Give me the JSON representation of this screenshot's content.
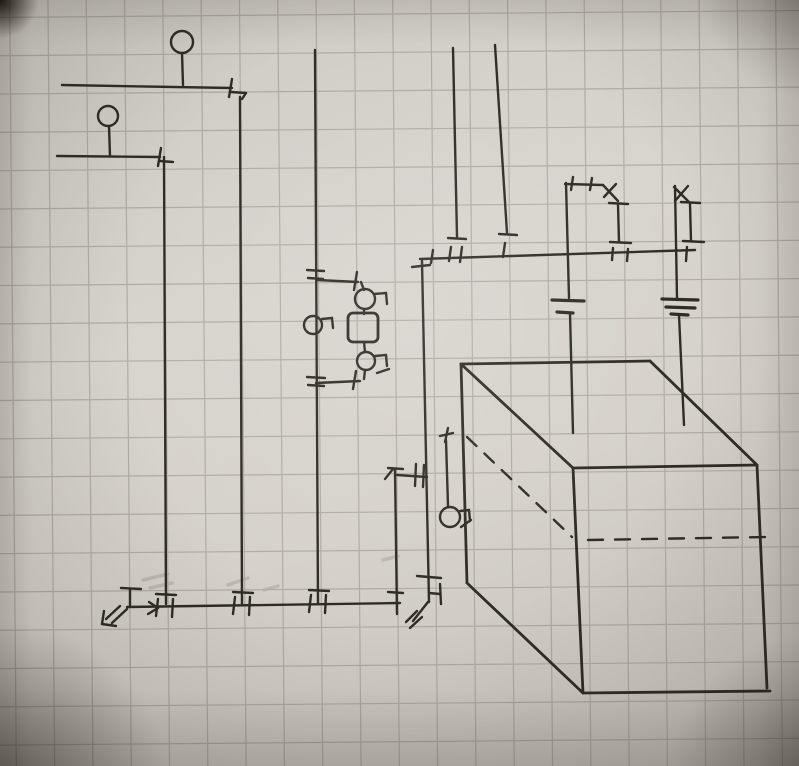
{
  "scene": {
    "description": "Photograph of a hand-drawn plumbing/heating schematic sketch in black ink on squared graph paper: pipe runs with valve ticks, two lollipop circles, a pump-bypass loop with a rounded square component, a top manifold bus with two battery-like symbols, a hanging circle sensor, a bottom manifold with arrow squiggles, and an oblique 3D box (tank) with dashed hidden lines.",
    "width": 799,
    "height": 766
  },
  "paper": {
    "color": "#d6d2cc"
  },
  "grid": {
    "spacing_x": 38.3,
    "spacing_y": 38.3,
    "offset_x": 13,
    "offset_y": 14,
    "color": "#8d887e",
    "opacity": 0.5,
    "width": 1.2,
    "rotation_deg": -0.5
  },
  "sketch": {
    "ink_color": "#2f2c27",
    "stroke_width": 2.4,
    "lines": [
      [
        182,
        53,
        183,
        85
      ],
      [
        62,
        85,
        232,
        88
      ],
      [
        232,
        79,
        229,
        97
      ],
      [
        231,
        92,
        246,
        93
      ],
      [
        246,
        93,
        242,
        99
      ],
      [
        240,
        97,
        242,
        604
      ],
      [
        109,
        126,
        110,
        156
      ],
      [
        57,
        156,
        160,
        157
      ],
      [
        161,
        148,
        158,
        166
      ],
      [
        160,
        161,
        173,
        162
      ],
      [
        164,
        157,
        166,
        604
      ],
      [
        315,
        50,
        318,
        604
      ],
      [
        307,
        270,
        324,
        271
      ],
      [
        308,
        278,
        323,
        279
      ],
      [
        317,
        280,
        358,
        282
      ],
      [
        357,
        272,
        354,
        290
      ],
      [
        361,
        282,
        364,
        290
      ],
      [
        374,
        294,
        386,
        293
      ],
      [
        386,
        293,
        387,
        304
      ],
      [
        364,
        309,
        364,
        314
      ],
      [
        364,
        342,
        365,
        352
      ],
      [
        375,
        356,
        386,
        355
      ],
      [
        386,
        355,
        387,
        366
      ],
      [
        377,
        373,
        389,
        369
      ],
      [
        365,
        370,
        364,
        379
      ],
      [
        356,
        371,
        353,
        389
      ],
      [
        316,
        383,
        360,
        381
      ],
      [
        307,
        377,
        325,
        378
      ],
      [
        308,
        385,
        324,
        386
      ],
      [
        322,
        319,
        332,
        318
      ],
      [
        332,
        318,
        333,
        328
      ],
      [
        127,
        607,
        400,
        603
      ],
      [
        130,
        589,
        130,
        607
      ],
      [
        121,
        588,
        141,
        589
      ],
      [
        127,
        609,
        112,
        623
      ],
      [
        120,
        606,
        106,
        619
      ],
      [
        104,
        611,
        102,
        624
      ],
      [
        102,
        624,
        116,
        626
      ],
      [
        149,
        602,
        158,
        608
      ],
      [
        158,
        608,
        148,
        614
      ],
      [
        156,
        594,
        176,
        595
      ],
      [
        158,
        599,
        156,
        616
      ],
      [
        173,
        599,
        172,
        617
      ],
      [
        233,
        592,
        253,
        593
      ],
      [
        235,
        597,
        233,
        614
      ],
      [
        250,
        597,
        249,
        615
      ],
      [
        309,
        590,
        329,
        591
      ],
      [
        311,
        595,
        309,
        612
      ],
      [
        326,
        595,
        325,
        613
      ],
      [
        395,
        470,
        397,
        614
      ],
      [
        388,
        468,
        403,
        469
      ],
      [
        385,
        479,
        393,
        469
      ],
      [
        388,
        592,
        403,
        593
      ],
      [
        397,
        475,
        427,
        477
      ],
      [
        416,
        464,
        415,
        486
      ],
      [
        424,
        465,
        423,
        487
      ],
      [
        422,
        261,
        429,
        602
      ],
      [
        412,
        267,
        430,
        265
      ],
      [
        417,
        576,
        441,
        578
      ],
      [
        440,
        584,
        441,
        604
      ],
      [
        429,
        593,
        440,
        594
      ],
      [
        428,
        602,
        413,
        621
      ],
      [
        417,
        611,
        406,
        622
      ],
      [
        422,
        617,
        410,
        628
      ],
      [
        446,
        440,
        448,
        506
      ],
      [
        440,
        436,
        453,
        433
      ],
      [
        448,
        428,
        445,
        442
      ],
      [
        460,
        511,
        469,
        510
      ],
      [
        469,
        510,
        470,
        521
      ],
      [
        461,
        527,
        471,
        520
      ],
      [
        420,
        259,
        695,
        250
      ],
      [
        431,
        263,
        433,
        250
      ],
      [
        453,
        48,
        457,
        237
      ],
      [
        448,
        238,
        466,
        239
      ],
      [
        451,
        247,
        449,
        261
      ],
      [
        462,
        247,
        460,
        262
      ],
      [
        495,
        45,
        507,
        233
      ],
      [
        499,
        234,
        517,
        235
      ],
      [
        505,
        243,
        503,
        257
      ],
      [
        618,
        205,
        619,
        242
      ],
      [
        609,
        203,
        628,
        204
      ],
      [
        610,
        242,
        631,
        243
      ],
      [
        613,
        248,
        612,
        260
      ],
      [
        628,
        249,
        627,
        261
      ],
      [
        690,
        204,
        691,
        241
      ],
      [
        681,
        202,
        700,
        203
      ],
      [
        683,
        241,
        704,
        242
      ],
      [
        687,
        247,
        686,
        261
      ],
      [
        566,
        183,
        569,
        298
      ],
      [
        565,
        184,
        603,
        185
      ],
      [
        573,
        177,
        571,
        190
      ],
      [
        592,
        178,
        590,
        190
      ],
      [
        603,
        185,
        618,
        201
      ],
      [
        604,
        197,
        616,
        184
      ],
      [
        552,
        300,
        584,
        301,
        3.2
      ],
      [
        557,
        312,
        573,
        313,
        3.2
      ],
      [
        570,
        313,
        573,
        433
      ],
      [
        674,
        187,
        689,
        202
      ],
      [
        675,
        201,
        688,
        186
      ],
      [
        675,
        186,
        677,
        298
      ],
      [
        662,
        299,
        698,
        300,
        3.2
      ],
      [
        666,
        307,
        695,
        308,
        3.2
      ],
      [
        671,
        314,
        688,
        315,
        3.2
      ],
      [
        679,
        315,
        684,
        425
      ],
      [
        461,
        364,
        650,
        361,
        2.8
      ],
      [
        461,
        364,
        467,
        583,
        2.8
      ],
      [
        461,
        364,
        573,
        468,
        2.8
      ],
      [
        650,
        361,
        757,
        465,
        2.8
      ],
      [
        573,
        468,
        757,
        465,
        2.8
      ],
      [
        573,
        468,
        583,
        693,
        2.8
      ],
      [
        757,
        465,
        767,
        688,
        2.8
      ],
      [
        583,
        693,
        770,
        691,
        2.8
      ],
      [
        467,
        583,
        583,
        693,
        2.8
      ]
    ],
    "dashed_lines": [
      [
        467,
        437,
        572,
        537,
        "13 11"
      ],
      [
        588,
        540,
        766,
        537,
        "15 12"
      ]
    ],
    "circles": [
      [
        182,
        42,
        11
      ],
      [
        108,
        116,
        10
      ],
      [
        365,
        299,
        10
      ],
      [
        366,
        361,
        9
      ],
      [
        313,
        325,
        9
      ],
      [
        450,
        517,
        10
      ]
    ],
    "rounded_rects": [
      [
        348,
        313,
        30,
        29,
        5
      ]
    ],
    "smudges": {
      "color": "#b4afa6",
      "opacity": 0.7,
      "width": 3.5,
      "lines": [
        [
          143,
          580,
          168,
          574
        ],
        [
          150,
          588,
          172,
          583
        ],
        [
          228,
          585,
          248,
          578
        ],
        [
          383,
          560,
          398,
          556
        ],
        [
          264,
          590,
          278,
          586
        ]
      ]
    }
  }
}
